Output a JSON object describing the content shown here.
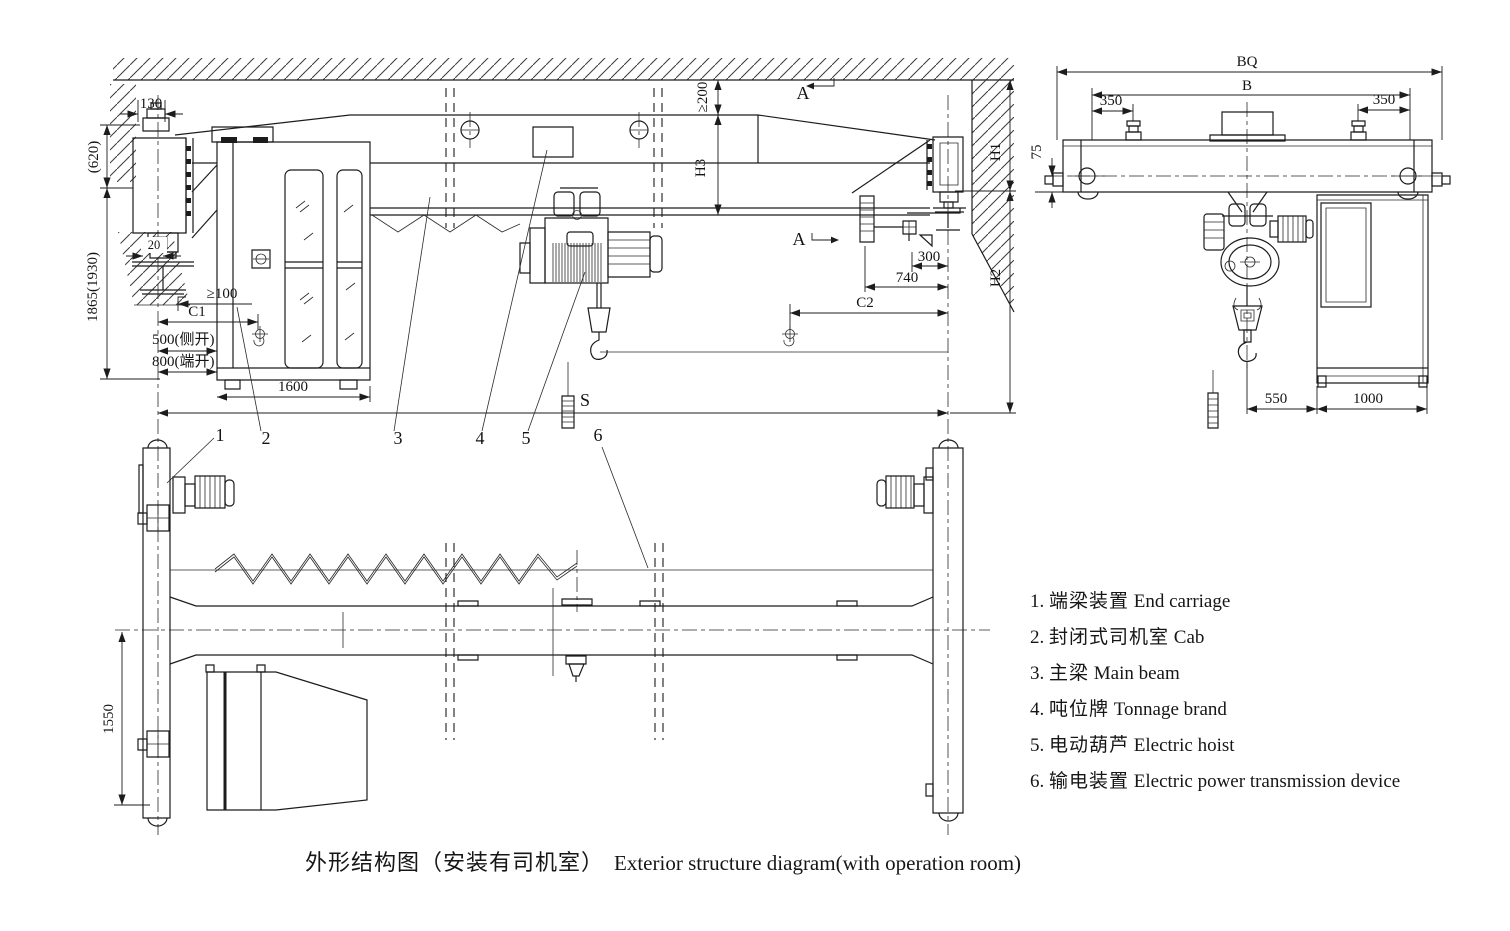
{
  "title": {
    "zh": "外形结构图（安装有司机室）",
    "en": "Exterior structure diagram(with operation room)"
  },
  "legend": {
    "items": [
      {
        "num": "1.",
        "zh": "端梁装置",
        "en": "End carriage"
      },
      {
        "num": "2.",
        "zh": "封闭式司机室",
        "en": "Cab"
      },
      {
        "num": "3.",
        "zh": "主梁",
        "en": "Main beam"
      },
      {
        "num": "4.",
        "zh": "吨位牌",
        "en": "Tonnage brand"
      },
      {
        "num": "5.",
        "zh": "电动葫芦",
        "en": "Electric hoist"
      },
      {
        "num": "6.",
        "zh": "输电装置",
        "en": "Electric power transmission device"
      }
    ]
  },
  "elevation": {
    "section_label": "A",
    "callouts": [
      "1",
      "2",
      "3",
      "4",
      "5",
      "6"
    ],
    "dims": {
      "d130": "130",
      "d620": "(620)",
      "d1865": "1865(1930)",
      "d20": "20",
      "dge100": "≥100",
      "dC1": "C1",
      "d500": "500(侧开)",
      "d800": "800(端开)",
      "d1600": "1600",
      "dge200": "≥200",
      "dH3": "H3",
      "d300": "300",
      "d740": "740",
      "dC2": "C2",
      "dH1": "H1",
      "dH2": "H2",
      "dS": "S"
    }
  },
  "side_view": {
    "dims": {
      "dBQ": "BQ",
      "dB": "B",
      "d350l": "350",
      "d350r": "350",
      "d75": "75",
      "d550": "550",
      "d1000": "1000"
    }
  },
  "plan_view": {
    "dims": {
      "d1550": "1550"
    }
  },
  "colors": {
    "line": "#1c1c1c",
    "background": "#ffffff"
  }
}
